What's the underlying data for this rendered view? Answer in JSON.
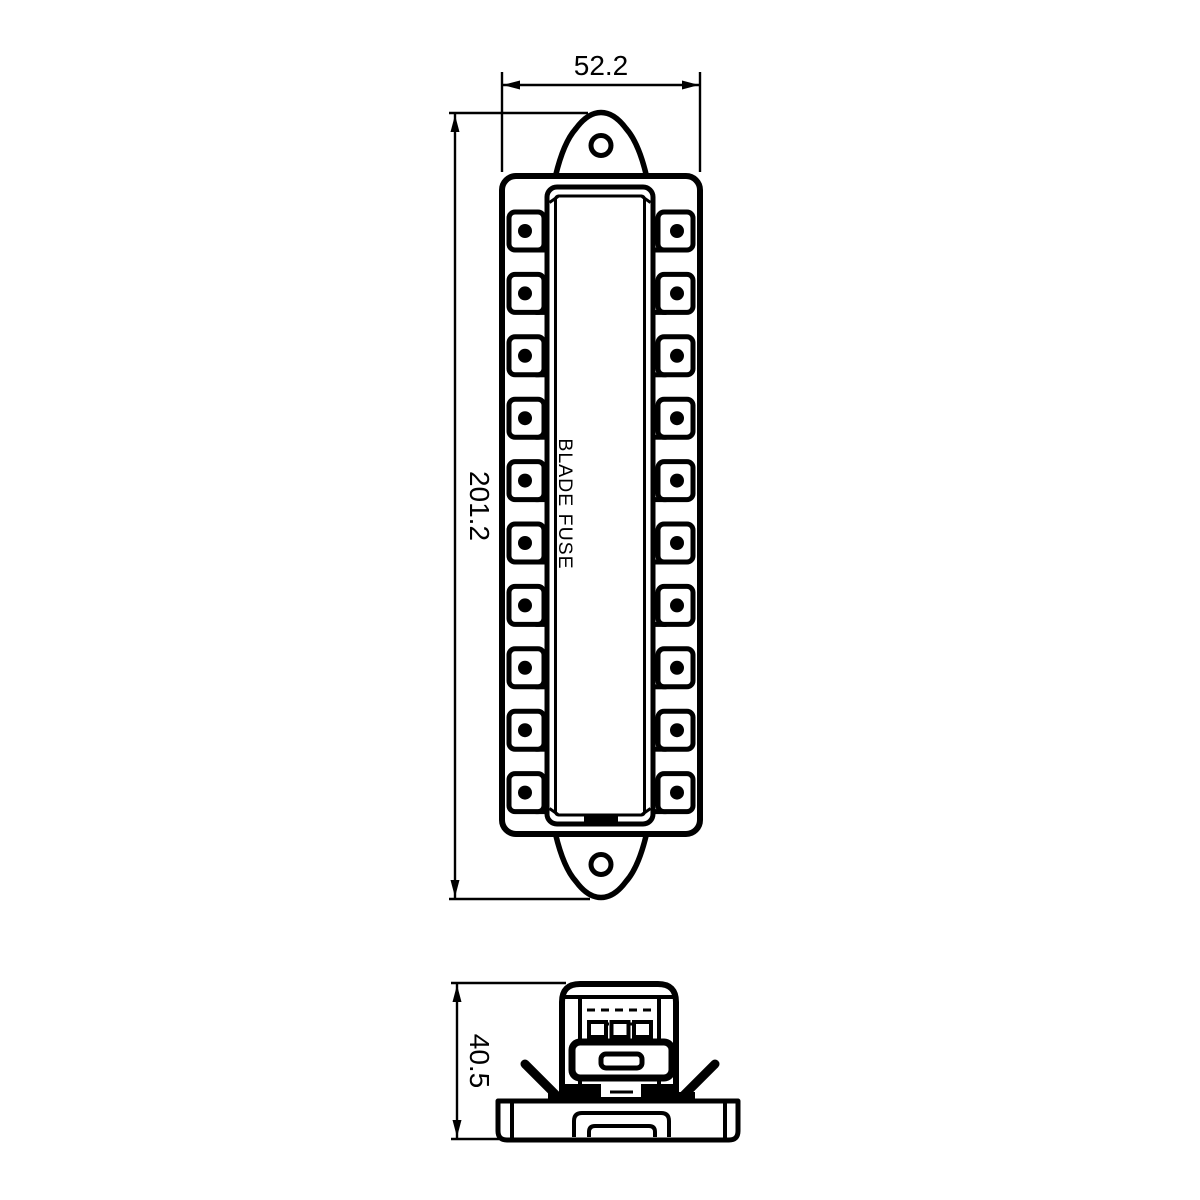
{
  "labels": {
    "top_width": "52.2",
    "overall_height": "201.2",
    "side_height": "40.5",
    "product": "BLADE FUSE"
  },
  "colors": {
    "line": "#000000",
    "background": "#ffffff"
  },
  "top_view": {
    "terminals_per_side": 10,
    "terminal_first_cy": 231,
    "terminal_spacing": 62.4
  },
  "side_view": {
    "fuse_count": 3,
    "fuse_first_x": 589,
    "fuse_spacing": 22.5
  }
}
